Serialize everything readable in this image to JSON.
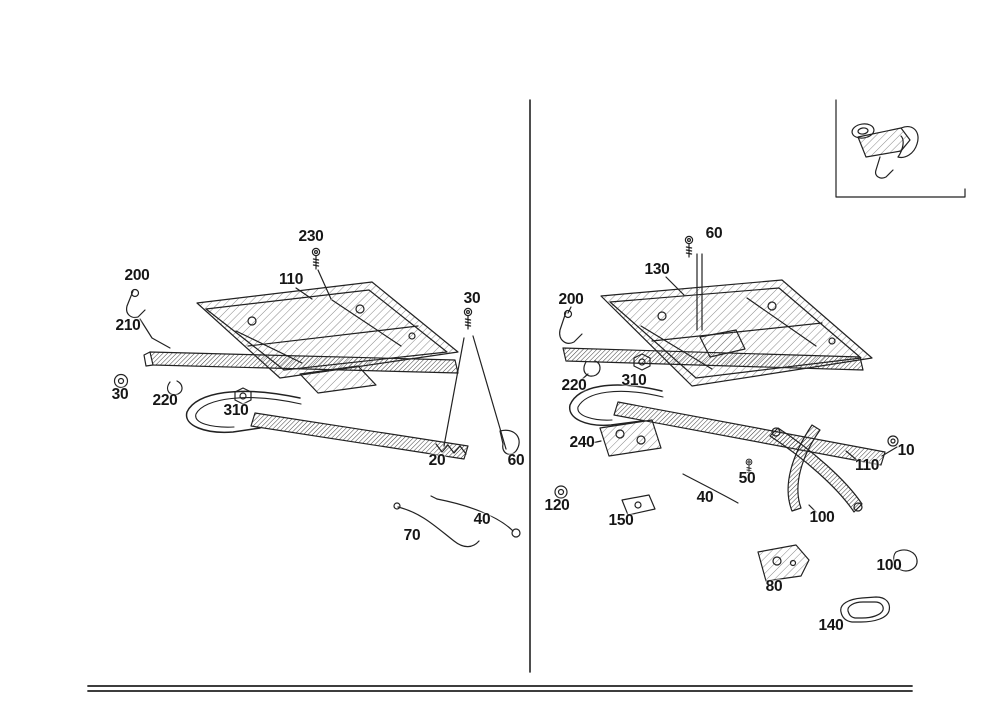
{
  "colors": {
    "background": "#ffffff",
    "ink": "#222222"
  },
  "icons": {
    "hardware": [
      "bolt-icon",
      "nut-icon",
      "washer-icon",
      "clip-icon",
      "spring-icon",
      "lever-icon",
      "rod-icon",
      "handle-bar",
      "slide-rail",
      "seat-frame",
      "latch-hook",
      "cover-plate",
      "foot-bracket"
    ]
  },
  "part_labels": {
    "left": [
      {
        "text": "230",
        "x": 311,
        "y": 237
      },
      {
        "text": "110",
        "x": 291,
        "y": 280
      },
      {
        "text": "200",
        "x": 137,
        "y": 276
      },
      {
        "text": "210",
        "x": 128,
        "y": 326
      },
      {
        "text": "30",
        "x": 472,
        "y": 299
      },
      {
        "text": "30",
        "x": 120,
        "y": 395
      },
      {
        "text": "220",
        "x": 165,
        "y": 401
      },
      {
        "text": "310",
        "x": 236,
        "y": 411
      },
      {
        "text": "20",
        "x": 437,
        "y": 461
      },
      {
        "text": "60",
        "x": 516,
        "y": 461
      },
      {
        "text": "40",
        "x": 482,
        "y": 520
      },
      {
        "text": "70",
        "x": 412,
        "y": 536
      }
    ],
    "right": [
      {
        "text": "60",
        "x": 714,
        "y": 234
      },
      {
        "text": "130",
        "x": 657,
        "y": 270
      },
      {
        "text": "200",
        "x": 571,
        "y": 300
      },
      {
        "text": "220",
        "x": 574,
        "y": 386
      },
      {
        "text": "310",
        "x": 634,
        "y": 381
      },
      {
        "text": "240",
        "x": 582,
        "y": 443
      },
      {
        "text": "120",
        "x": 557,
        "y": 506
      },
      {
        "text": "150",
        "x": 621,
        "y": 521
      },
      {
        "text": "40",
        "x": 705,
        "y": 498
      },
      {
        "text": "50",
        "x": 747,
        "y": 479
      },
      {
        "text": "110",
        "x": 867,
        "y": 466
      },
      {
        "text": "10",
        "x": 906,
        "y": 451
      },
      {
        "text": "100",
        "x": 822,
        "y": 518
      },
      {
        "text": "80",
        "x": 774,
        "y": 587
      },
      {
        "text": "100",
        "x": 889,
        "y": 566
      },
      {
        "text": "140",
        "x": 831,
        "y": 626
      }
    ]
  }
}
